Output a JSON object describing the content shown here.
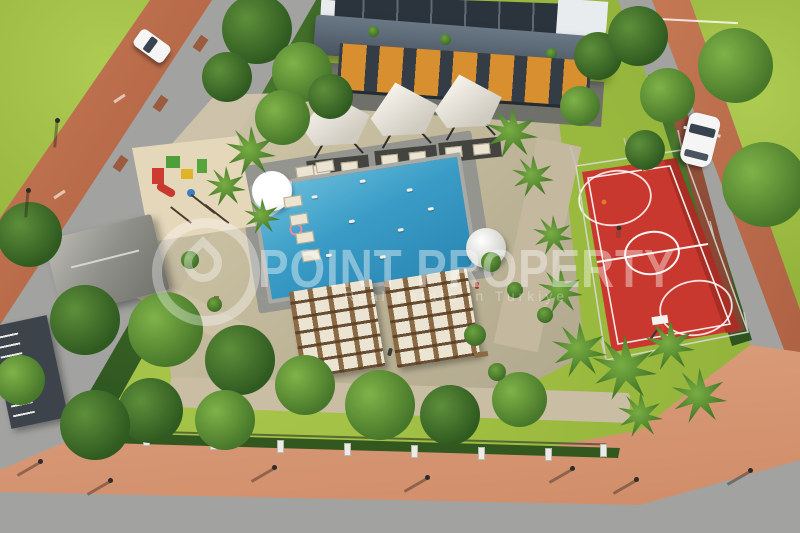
{
  "scene": {
    "type": "aerial-3d-architectural-render",
    "description": "Bird's-eye 3D rendering of a residential complex courtyard with swimming pool, sun lounger decks, shade cabanas, red basketball court, children's playground, gardens, perimeter roads and parked cars",
    "features": [
      "apartment-building",
      "swimming-pool",
      "sun-lounger-decks",
      "shade-cabanas",
      "basketball-court",
      "playground",
      "garden-kiosk",
      "perimeter-road",
      "sidewalks",
      "street-lamps",
      "palm-trees",
      "white-cars"
    ]
  },
  "watermark": {
    "logo": "ring-pin-logo",
    "title": "POINT PROPERTY",
    "subtitle": "Real Estate in Turkiye"
  },
  "colors": {
    "road": "#a2a2a0",
    "sidewalk": "#c0714e",
    "sidewalk_bottom": "#d89a7a",
    "grass": "#9dbc40",
    "grass_light": "#b2cd55",
    "pool_water": "#3a9cc6",
    "pool_deck": "#94958f",
    "court_red": "#c9382e",
    "court_line": "#ffffff",
    "building_dark": "#39424b",
    "building_slate": "#5d6a77",
    "building_white": "#e9ecee",
    "window_orange": "#d88f2f",
    "canopy_white": "#f6f3ec",
    "wood": "#8a6a45",
    "lounger_cream": "#ece4d2",
    "sand": "#e4d7ba",
    "tree_dark": "#2f5a20",
    "tree_mid": "#47772a",
    "brick_wall": "#8a4a36",
    "car_white": "#f4f5f4",
    "watermark_white": "#ffffff"
  }
}
